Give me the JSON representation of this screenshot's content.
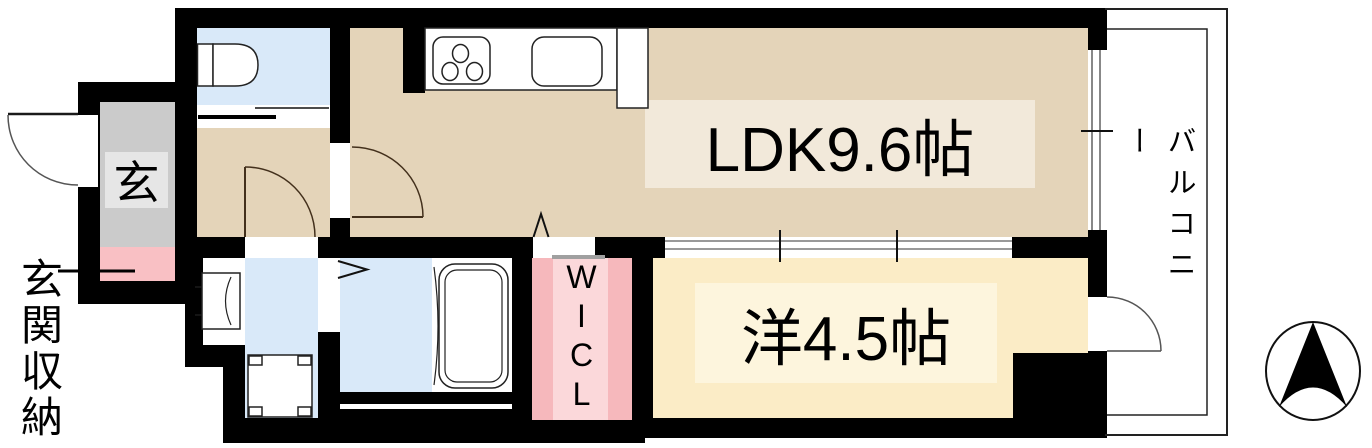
{
  "plan_title": "1K floor plan",
  "rooms": {
    "ldk": {
      "label": "LDK9.6帖"
    },
    "bedroom": {
      "label": "洋4.5帖"
    },
    "wicl": {
      "label": "WICL"
    },
    "balcony": {
      "label": "バルコニー"
    },
    "entrance": {
      "label": "玄"
    }
  },
  "annotations": {
    "entrance_storage": {
      "label": "玄関収納"
    }
  },
  "icons": {
    "compass": "north-arrow-icon",
    "fixtures": [
      "toilet-icon",
      "kitchen-stove-icon",
      "kitchen-sink-icon",
      "washbasin-icon",
      "washing-machine-pan-icon",
      "bathtub-icon",
      "door-swing-icon",
      "folding-door-icon",
      "sliding-door-icon"
    ]
  },
  "colors": {
    "wall": "#000000",
    "floor_ldk_hall": "#e4d4b9",
    "floor_bedroom": "#fbecc6",
    "wet_room_blue": "#d9e9f9",
    "wicl_pink": "#f6b8bc",
    "wicl_pink_light": "#fbd8da",
    "entrance_gray": "#cbcbcb",
    "entrance_storage_pink": "#f9c0c4",
    "ldk_label_band": "#f2e9da",
    "bedroom_label_band": "#fdf5dd"
  }
}
